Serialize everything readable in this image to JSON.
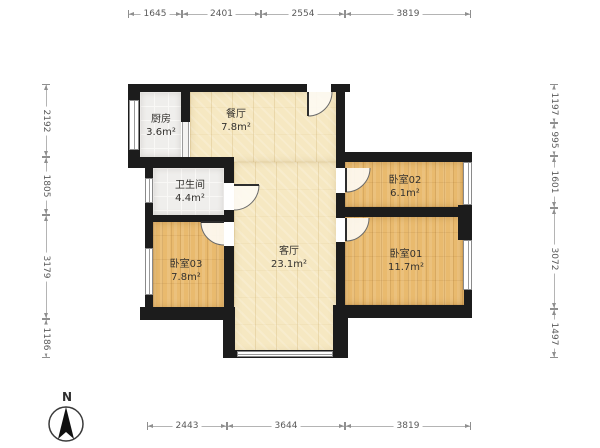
{
  "compass": {
    "label": "N"
  },
  "colors": {
    "wall": "#1c1c1c",
    "floor_light_wood": "#f6e8c2",
    "floor_orange_wood": "#e9ba6e",
    "floor_tile": "#efeeec",
    "dimension_line": "#8f8f8f",
    "dimension_text": "#5a5a5a",
    "label_text": "#33312e"
  },
  "rooms": [
    {
      "id": "kitchen",
      "name": "厨房",
      "area": "3.6m²",
      "floor": "tile",
      "rect": [
        140,
        92,
        41,
        65
      ],
      "label_at": [
        161,
        126
      ]
    },
    {
      "id": "dining",
      "name": "餐厅",
      "area": "7.8m²",
      "floor": "wood_light",
      "rect": [
        190,
        92,
        146,
        70
      ],
      "label_at": [
        236,
        121
      ]
    },
    {
      "id": "living",
      "name": "客厅",
      "area": "23.1m²",
      "floor": "wood_light",
      "rect": [
        234,
        162,
        102,
        190
      ],
      "label_at": [
        289,
        258
      ]
    },
    {
      "id": "bathroom",
      "name": "卫生间",
      "area": "4.4m²",
      "floor": "tile",
      "rect": [
        153,
        168,
        71,
        47
      ],
      "label_at": [
        190,
        192
      ]
    },
    {
      "id": "bedroom03",
      "name": "卧室03",
      "area": "7.8m²",
      "floor": "wood_orange",
      "rect": [
        153,
        222,
        71,
        86
      ],
      "label_at": [
        186,
        271
      ]
    },
    {
      "id": "bedroom02",
      "name": "卧室02",
      "area": "6.1m²",
      "floor": "wood_orange",
      "rect": [
        345,
        162,
        119,
        45
      ],
      "label_at": [
        405,
        187
      ]
    },
    {
      "id": "bedroom01",
      "name": "卧室01",
      "area": "11.7m²",
      "floor": "wood_orange",
      "rect": [
        345,
        217,
        119,
        88
      ],
      "label_at": [
        406,
        261
      ]
    }
  ],
  "walls": [
    [
      128,
      84,
      179,
      8
    ],
    [
      331,
      84,
      19,
      8
    ],
    [
      336,
      84,
      9,
      84
    ],
    [
      336,
      152,
      136,
      10
    ],
    [
      464,
      152,
      8,
      166
    ],
    [
      458,
      205,
      14,
      35
    ],
    [
      345,
      305,
      127,
      13
    ],
    [
      333,
      305,
      15,
      53
    ],
    [
      223,
      350,
      125,
      8
    ],
    [
      223,
      307,
      12,
      51
    ],
    [
      140,
      307,
      95,
      13
    ],
    [
      145,
      160,
      8,
      160
    ],
    [
      128,
      84,
      12,
      78
    ],
    [
      128,
      157,
      106,
      11
    ],
    [
      181,
      84,
      9,
      38
    ],
    [
      224,
      160,
      10,
      23
    ],
    [
      224,
      210,
      10,
      12
    ],
    [
      147,
      215,
      87,
      7
    ],
    [
      224,
      246,
      10,
      61
    ],
    [
      336,
      193,
      9,
      25
    ],
    [
      336,
      242,
      9,
      66
    ],
    [
      336,
      207,
      136,
      10
    ]
  ],
  "windows": [
    {
      "orient": "v",
      "rect": [
        129,
        100,
        10,
        50
      ]
    },
    {
      "orient": "v",
      "rect": [
        145,
        178,
        8,
        25
      ]
    },
    {
      "orient": "v",
      "rect": [
        145,
        248,
        8,
        47
      ]
    },
    {
      "orient": "v",
      "rect": [
        463,
        162,
        9,
        43
      ]
    },
    {
      "orient": "v",
      "rect": [
        463,
        240,
        9,
        50
      ]
    },
    {
      "orient": "h",
      "rect": [
        237,
        351,
        96,
        6
      ]
    }
  ],
  "sliding_door": {
    "rect": [
      182,
      122,
      7,
      35
    ]
  },
  "doors": [
    {
      "id": "entry",
      "sector": "M308,92 L332,92 A24,24 0 0 1 308,116 Z",
      "arc": "M332,92 A24,24 0 0 1 308,116",
      "leaf": "M308,92 L308,116"
    },
    {
      "id": "bathroom-door",
      "sector": "M234,185 L259,185 A25,25 0 0 1 234,210 Z",
      "arc": "M259,185 A25,25 0 0 1 234,210",
      "leaf": "M234,185 L259,185"
    },
    {
      "id": "bedroom03-door",
      "sector": "M224,222 L201,222 A23,23 0 0 0 224,245 Z",
      "arc": "M201,222 A23,23 0 0 0 224,245",
      "leaf": "M224,222 L201,222"
    },
    {
      "id": "bedroom02-door",
      "sector": "M346,168 L346,192 A24,24 0 0 0 370,168 Z",
      "arc": "M346,192 A24,24 0 0 0 370,168",
      "leaf": "M346,168 L346,192"
    },
    {
      "id": "bedroom01-door",
      "sector": "M346,218 L346,241 A23,23 0 0 0 369,218 Z",
      "arc": "M346,241 A23,23 0 0 0 369,218",
      "leaf": "M346,218 L346,241"
    }
  ],
  "dimensions": {
    "top": {
      "axis": 14,
      "ticks": [
        128,
        182,
        261,
        345,
        471
      ],
      "labels": [
        "1645",
        "2401",
        "2554",
        "3819"
      ]
    },
    "bottom": {
      "axis": 426,
      "ticks": [
        147,
        227,
        345,
        471
      ],
      "labels": [
        "2443",
        "3644",
        "3819"
      ]
    },
    "left": {
      "axis": 46,
      "ticks": [
        84,
        157,
        215,
        319,
        358
      ],
      "labels": [
        "2192",
        "1805",
        "3179",
        "1186"
      ]
    },
    "right": {
      "axis": 554,
      "ticks": [
        84,
        123,
        156,
        208,
        309,
        358
      ],
      "labels": [
        "1197",
        "995",
        "1601",
        "3072",
        "1497"
      ]
    }
  }
}
